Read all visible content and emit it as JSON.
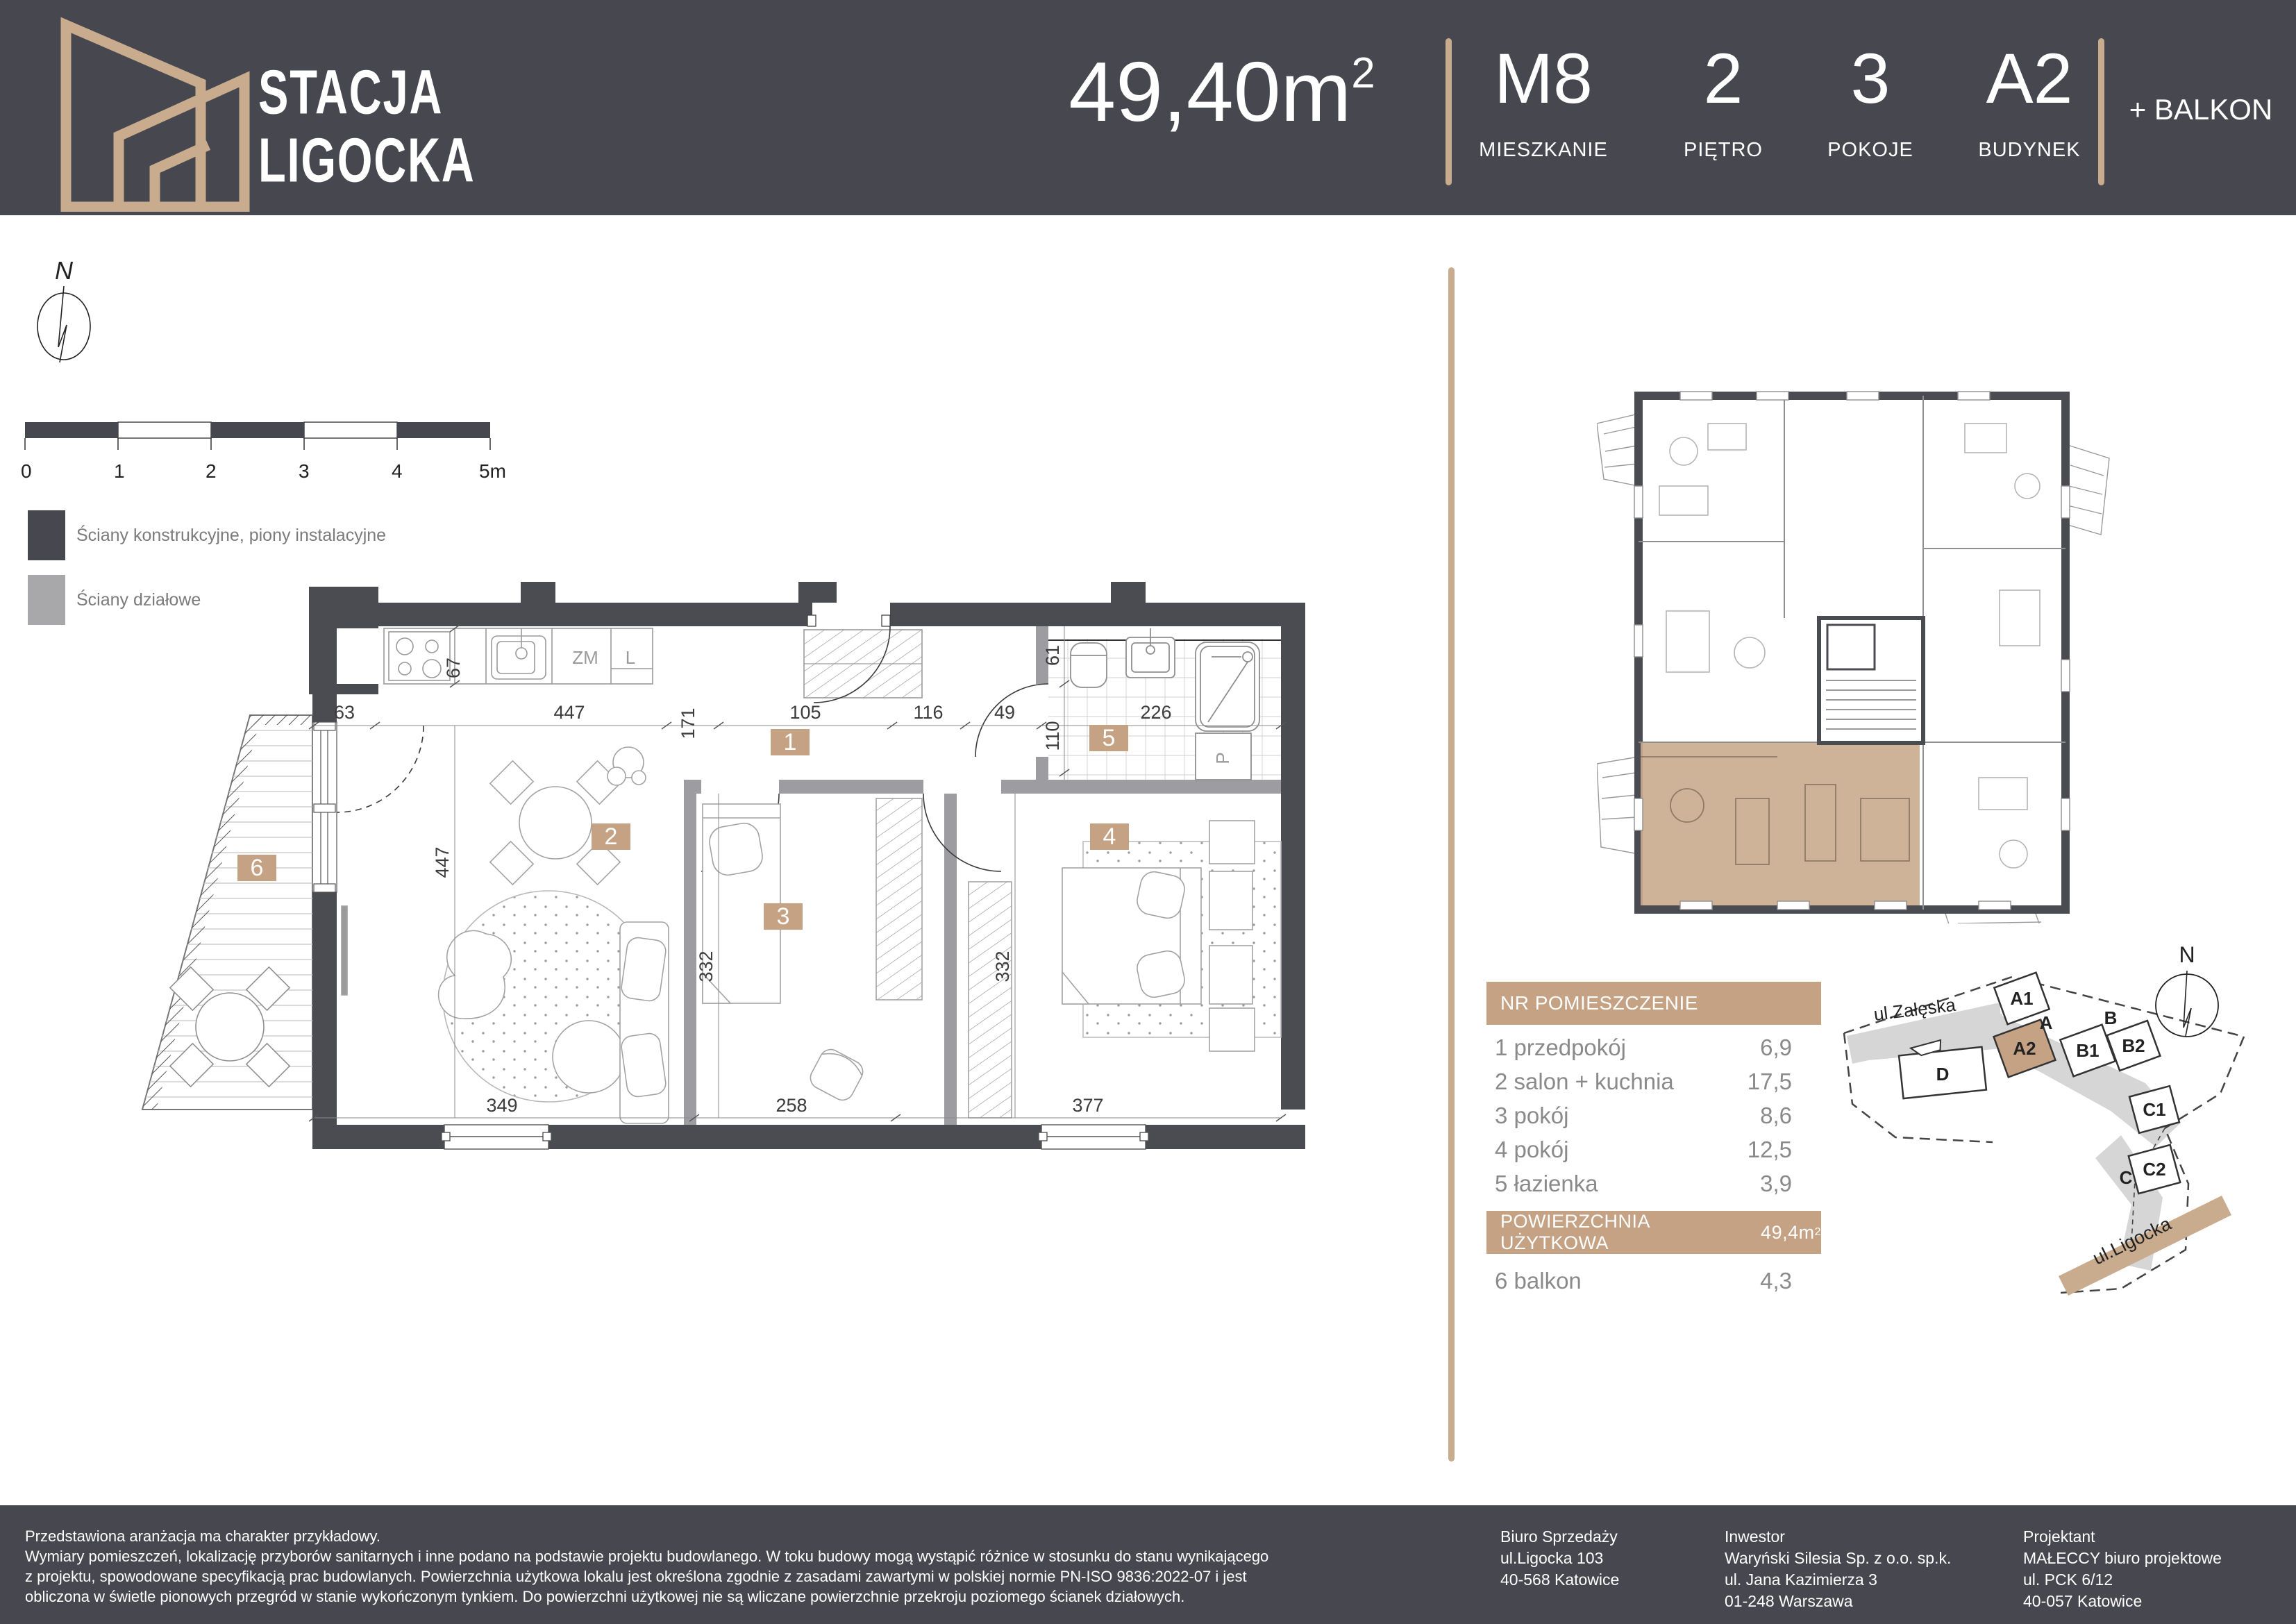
{
  "header": {
    "brand_line1": "STACJA",
    "brand_line2": "LIGOCKA",
    "area_value": "49,40m",
    "area_sup": "2",
    "stats": [
      {
        "value": "M8",
        "label": "MIESZKANIE"
      },
      {
        "value": "2",
        "label": "PIĘTRO"
      },
      {
        "value": "3",
        "label": "POKOJE"
      },
      {
        "value": "A2",
        "label": "BUDYNEK"
      }
    ],
    "balcony": "+ BALKON"
  },
  "colors": {
    "accent": "#c5a284",
    "accent_light": "#c9ab8e",
    "dark": "#47474f",
    "partition": "#9d9da1"
  },
  "compass": {
    "north": "N"
  },
  "scalebar": {
    "ticks": [
      "0",
      "1",
      "2",
      "3",
      "4",
      "5m"
    ]
  },
  "legend": {
    "item1": "Ściany konstrukcyjne, piony instalacyjne",
    "item2": "Ściany działowe"
  },
  "floorplan": {
    "tags": {
      "t1": "1",
      "t2": "2",
      "t3": "3",
      "t4": "4",
      "t5": "5",
      "t6": "6"
    },
    "dims": {
      "d63": "63",
      "d447t": "447",
      "d171": "171",
      "d105": "105",
      "d116": "116",
      "d49": "49",
      "d226": "226",
      "d67": "67",
      "d61": "61",
      "d110": "110",
      "d447v": "447",
      "d332a": "332",
      "d332b": "332",
      "d349": "349",
      "d258": "258",
      "d377": "377"
    },
    "labels": {
      "dishwasher": "ZM",
      "fridge": "L",
      "washer": "P"
    }
  },
  "table": {
    "header": "NR  POMIESZCZENIE",
    "rows": [
      {
        "nr": "1",
        "name": "przedpokój",
        "area": "6,9"
      },
      {
        "nr": "2",
        "name": "salon + kuchnia",
        "area": "17,5"
      },
      {
        "nr": "3",
        "name": "pokój",
        "area": "8,6"
      },
      {
        "nr": "4",
        "name": "pokój",
        "area": "12,5"
      },
      {
        "nr": "5",
        "name": "łazienka",
        "area": "3,9"
      }
    ],
    "total_label": "POWIERZCHNIA UŻYTKOWA",
    "total_value": "49,4m",
    "total_sup": "2",
    "balcony_row": {
      "nr": "6",
      "name": "balkon",
      "area": "4,3"
    }
  },
  "sitemap": {
    "north": "N",
    "street_top": "ul.Załęska",
    "street_bottom": "ul.Ligocka",
    "b_a1": "A1",
    "b_a": "A",
    "b_a2": "A2",
    "b_b": "B",
    "b_b1": "B1",
    "b_b2": "B2",
    "b_c": "C",
    "b_c1": "C1",
    "b_c2": "C2",
    "b_d": "D"
  },
  "footer": {
    "disclaimer": [
      "Przedstawiona aranżacja ma charakter przykładowy.",
      "Wymiary pomieszczeń, lokalizację przyborów sanitarnych i inne podano na podstawie projektu budowlanego. W toku budowy mogą wystąpić różnice w stosunku do stanu wynikającego",
      "z projektu, spowodowane specyfikacją prac budowlanych. Powierzchnia użytkowa lokalu jest określona zgodnie z zasadami zawartymi w polskiej normie PN-ISO 9836:2022-07 i jest",
      "obliczona w świetle pionowych przegród w stanie wykończonym tynkiem. Do powierzchni użytkowej nie są wliczane powierzchnie przekroju poziomego ścianek działowych."
    ],
    "office1": {
      "title": "Biuro Sprzedaży",
      "l1": "ul.Ligocka 103",
      "l2": "40-568 Katowice",
      "l3": ""
    },
    "office2": {
      "title": "Inwestor",
      "l1": "Waryński Silesia Sp. z o.o. sp.k.",
      "l2": "ul. Jana Kazimierza 3",
      "l3": "01-248 Warszawa"
    },
    "office3": {
      "title": "Projektant",
      "l1": "MAŁECCY biuro projektowe",
      "l2": "ul. PCK 6/12",
      "l3": "40-057 Katowice"
    }
  }
}
